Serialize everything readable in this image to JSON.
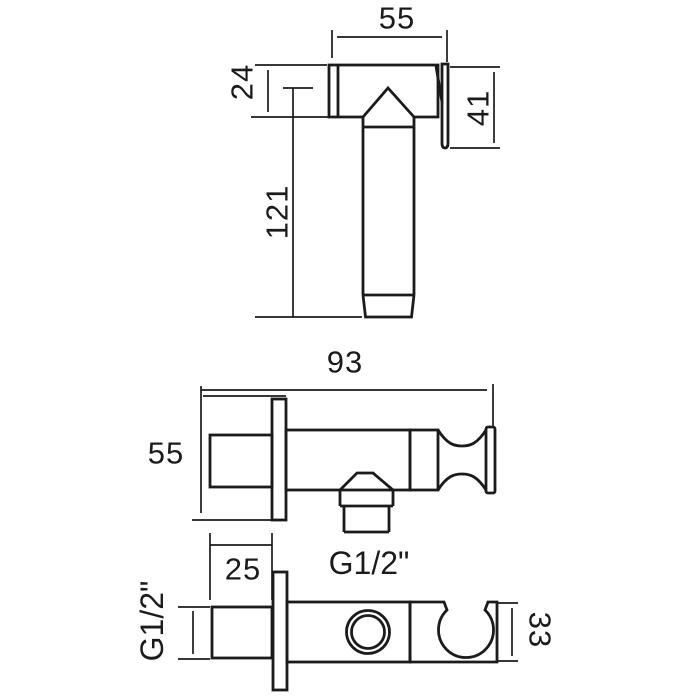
{
  "colors": {
    "background": "#ffffff",
    "line": "#1b1b1b",
    "text": "#1b1b1b"
  },
  "views": {
    "handset_top": {
      "dims": {
        "head_width": "55",
        "head_depth": "24",
        "hook_height": "41",
        "handle_length": "121"
      }
    },
    "bracket_side": {
      "dims": {
        "overall_length": "93",
        "plate_size": "55",
        "outlet_thread": "G1/2\""
      }
    },
    "bracket_bottom": {
      "dims": {
        "inlet_length": "25",
        "inlet_thread": "G1/2\"",
        "holder_depth": "33"
      }
    }
  }
}
